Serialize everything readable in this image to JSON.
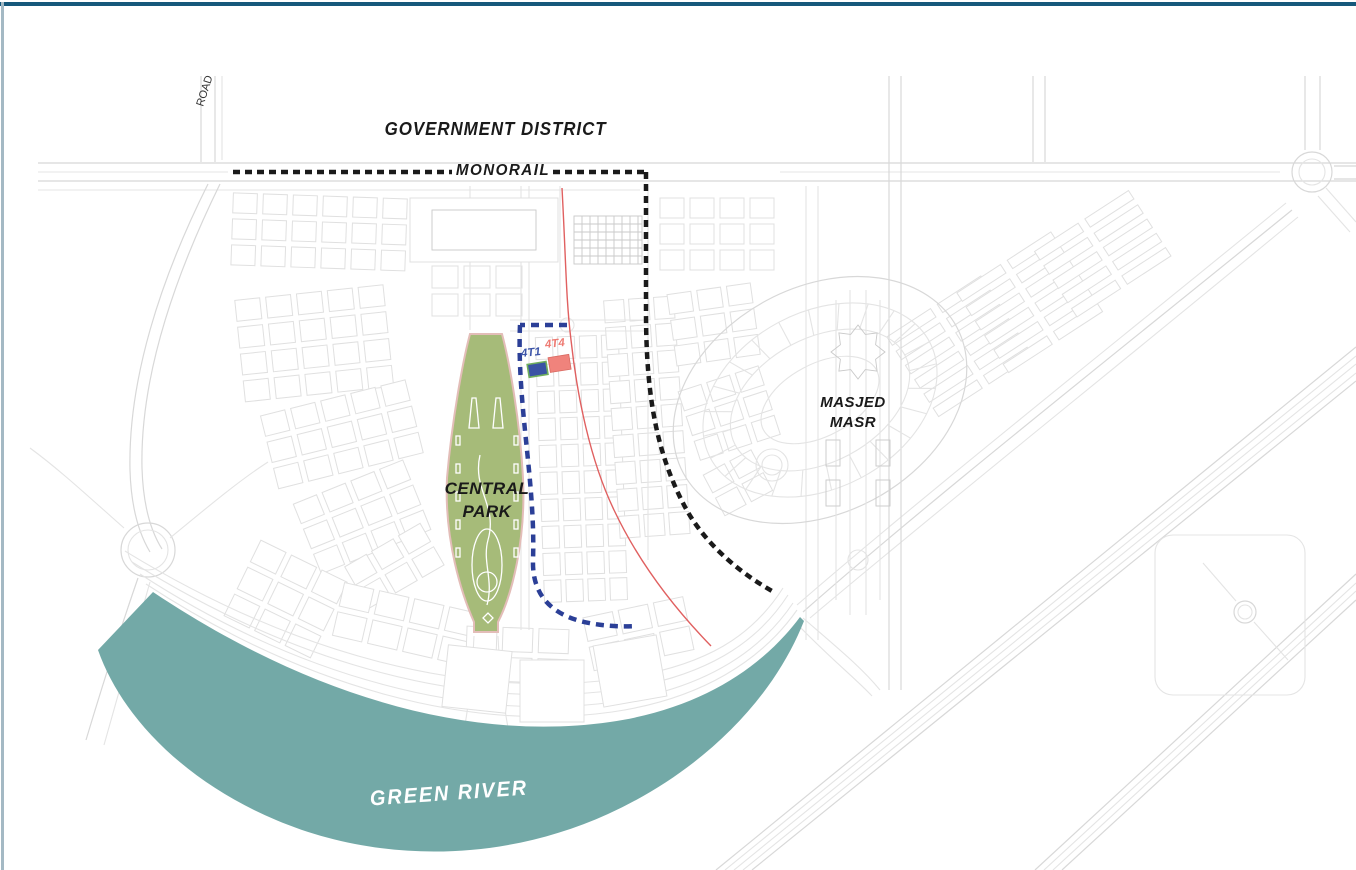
{
  "map": {
    "labels": {
      "government_district": "GOVERNMENT DISTRICT",
      "monorail": "MONORAIL",
      "road": "ROAD",
      "central_park_line1": "CENTRAL",
      "central_park_line2": "PARK",
      "masjed_line1": "MASJED",
      "masjed_line2": "MASR",
      "green_river": "GREEN RIVER",
      "plot_4t1": "4T1",
      "plot_4t4": "4T4"
    },
    "colors": {
      "frame_top": "#16587B",
      "frame_left": "#A4B9C4",
      "river": "#73A9A7",
      "park": "#A6BB79",
      "park_edge": "#E3BDB8",
      "monorail_line": "#1A1A1A",
      "boundary_dashed": "#2B3F97",
      "road_accent": "#E06060",
      "plot_4t1_fill": "#3A53A4",
      "plot_4t1_stroke": "#6FAE5C",
      "plot_4t1_label": "#3D55A8",
      "plot_4t4_fill": "#F0837C",
      "plot_4t4_stroke": "#D96A62",
      "plot_4t4_label": "#EE7A72"
    }
  }
}
